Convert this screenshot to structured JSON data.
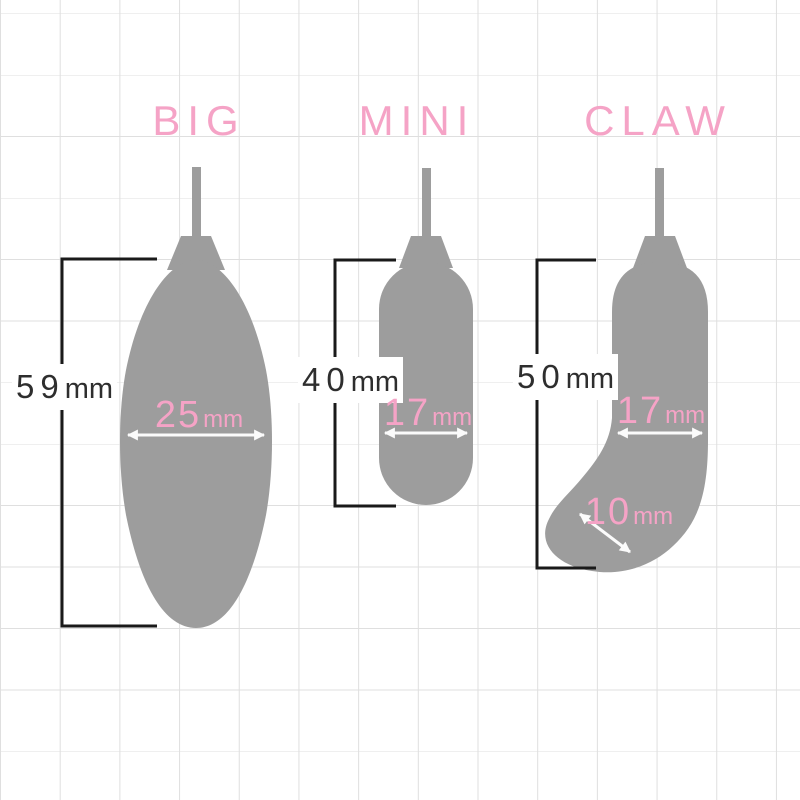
{
  "diagram": {
    "colors": {
      "accent_pink": "#F5A3C6",
      "silhouette_gray": "#9D9D9D",
      "grid_line": "#DFDFDF",
      "measure_text": "#2E2E2E",
      "bracket_line": "#1A1A1A",
      "arrow_white": "#FBFBFB"
    },
    "products": [
      {
        "name": "BIG",
        "length": "59",
        "length_unit": "mm",
        "width": "25",
        "width_unit": "mm"
      },
      {
        "name": "MINI",
        "length": "40",
        "length_unit": "mm",
        "width": "17",
        "width_unit": "mm"
      },
      {
        "name": "CLAW",
        "length": "50",
        "length_unit": "mm",
        "width": "17",
        "width_unit": "mm",
        "tip_width": "10",
        "tip_width_unit": "mm"
      }
    ]
  }
}
